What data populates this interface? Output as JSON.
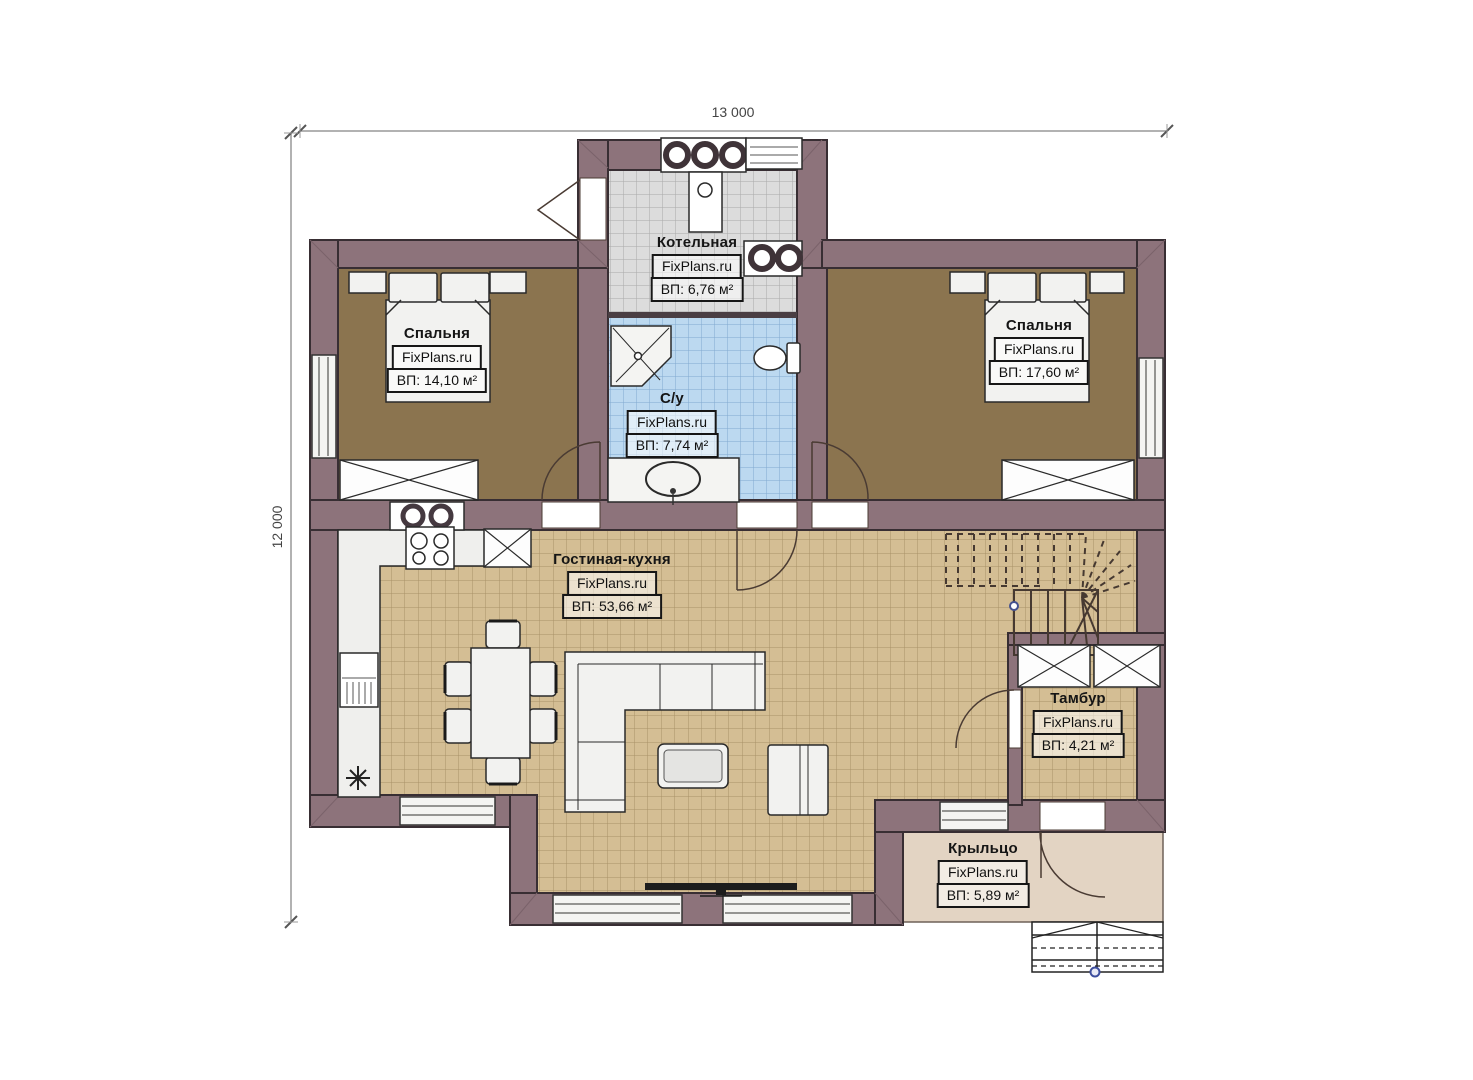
{
  "brand": "FixPlans.ru",
  "dimensions": {
    "width_label": "13 000",
    "height_label": "12 000"
  },
  "rooms": {
    "boiler": {
      "name": "Котельная",
      "area": "ВП: 6,76 м²"
    },
    "bedroom_left": {
      "name": "Спальня",
      "area": "ВП: 14,10 м²"
    },
    "bathroom": {
      "name": "С/у",
      "area": "ВП: 7,74 м²"
    },
    "bedroom_right": {
      "name": "Спальня",
      "area": "ВП: 17,60 м²"
    },
    "living": {
      "name": "Гостиная-кухня",
      "area": "ВП: 53,66 м²"
    },
    "vestibule": {
      "name": "Тамбур",
      "area": "ВП: 4,21 м²"
    },
    "porch": {
      "name": "Крыльцо",
      "area": "ВП: 5,89 м²"
    }
  },
  "colors": {
    "wall": "#8d737b",
    "wall_outline": "#382e33",
    "bedroom_floor": "#8b744f",
    "living_floor": "#d4be94",
    "bathroom_floor": "#bcd9f0",
    "boiler_floor": "#dcdcdc",
    "porch_floor": "#e3d4c3"
  }
}
